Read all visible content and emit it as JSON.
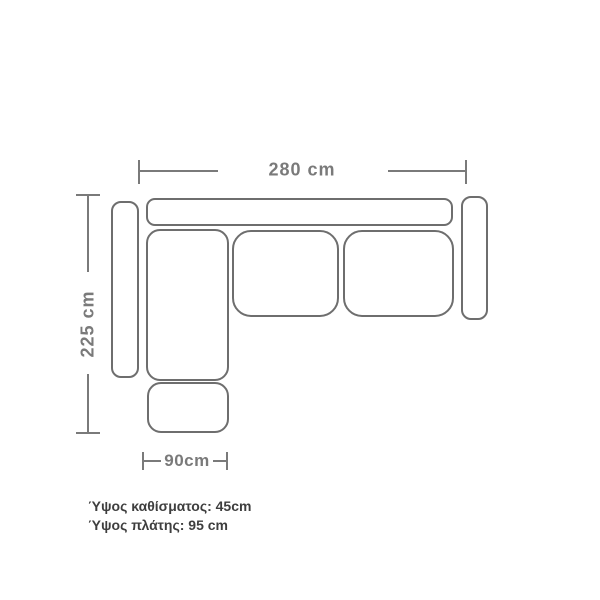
{
  "colors": {
    "background": "#ffffff",
    "outline": "#6e6e6e",
    "dimension_line": "#7a7a7a",
    "dimension_text": "#7a7a7a",
    "note_text": "#3e3e3e"
  },
  "dimensions": {
    "width": "280 cm",
    "depth": "225 cm",
    "ottoman_width": "90cm"
  },
  "notes": {
    "seat_height": "Ύψος καθίσματος: 45cm",
    "back_height": "Ύψος πλάτης: 95 cm"
  }
}
